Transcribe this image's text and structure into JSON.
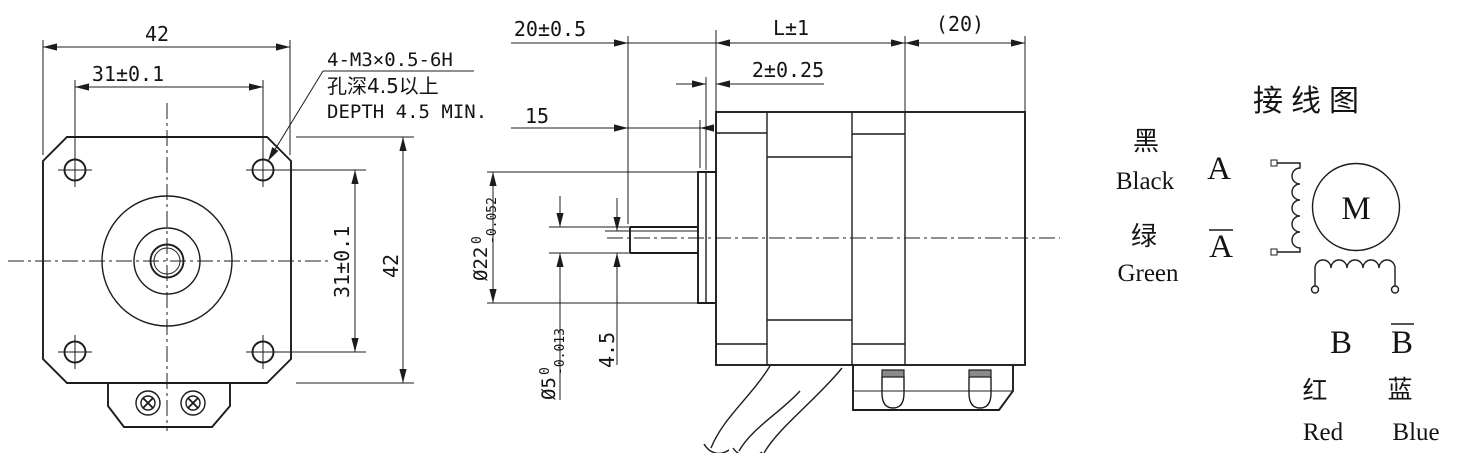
{
  "front_view": {
    "dim_width": "42",
    "dim_hole_spacing": "31±0.1",
    "dim_hole_spacing_v": "31±0.1",
    "dim_height": "42",
    "callout_thread": "4-M3×0.5-6H",
    "callout_depth_cn": "孔深4.5以上",
    "callout_depth_en": "DEPTH 4.5 MIN."
  },
  "side_view": {
    "dim_shaft_ext": "20±0.5",
    "dim_flat_len": "15",
    "dim_body_len": "L±1",
    "dim_rear_cover": "(20)",
    "dim_boss_height": "2±0.25",
    "dim_boss_dia": "Ø22",
    "dim_boss_dia_tol_sup": "0",
    "dim_boss_dia_tol_sub": "-0.052",
    "dim_shaft_dia": "Ø5",
    "dim_shaft_dia_tol_sup": "0",
    "dim_shaft_dia_tol_sub": "-0.013",
    "dim_flat_depth": "4.5"
  },
  "wiring": {
    "title": "接线图",
    "motor_label": "M",
    "lead_a": {
      "cn": "黑",
      "en": "Black",
      "phase": "A"
    },
    "lead_a_bar": {
      "cn": "绿",
      "en": "Green",
      "phase": "A"
    },
    "lead_b": {
      "cn": "红",
      "en": "Red",
      "phase": "B"
    },
    "lead_b_bar": {
      "cn": "蓝",
      "en": "Blue",
      "phase": "B"
    }
  },
  "colors": {
    "line": "#1c1c1c",
    "background": "#ffffff"
  }
}
